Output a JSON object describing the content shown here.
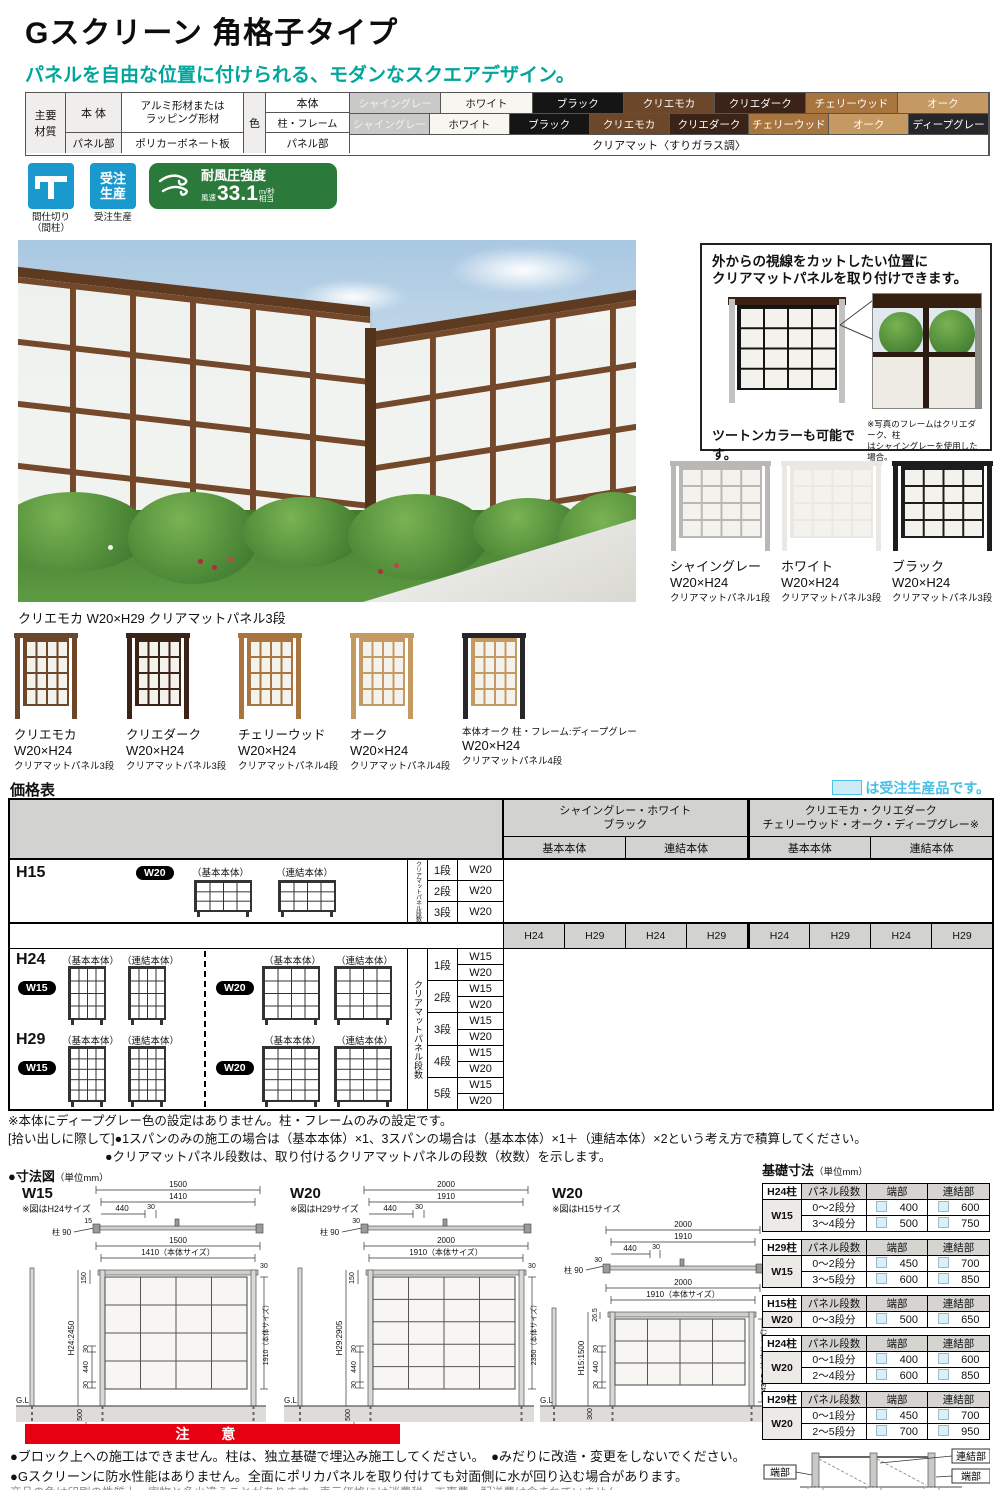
{
  "page": {
    "title": "Gスクリーン 角格子タイプ",
    "subtitle": "パネルを自由な位置に付けられる、モダンなスクエアデザイン。"
  },
  "spec": {
    "material_header_l1": "主要",
    "material_header_l2": "材質",
    "body_label": "本 体",
    "body_value_l1": "アルミ形材または",
    "body_value_l2": "ラッピング形材",
    "panel_label": "パネル部",
    "panel_value": "ポリカーボネート板",
    "color_header": "色",
    "row_body": "本体",
    "row_frame": "柱・フレーム",
    "row_panel": "パネル部",
    "panel_color_value": "クリアマット〈すりガラス調〉",
    "body_colors": [
      {
        "label": "シャイングレー",
        "bg": "#c9c9c7",
        "fg": "#f2f2f0"
      },
      {
        "label": "ホワイト",
        "bg": "#f7f6f1",
        "fg": "#1a1a1a"
      },
      {
        "label": "ブラック",
        "bg": "#151515",
        "fg": "#ffffff"
      },
      {
        "label": "クリエモカ",
        "bg": "#6d4729",
        "fg": "#ffffff"
      },
      {
        "label": "クリエダーク",
        "bg": "#3b2317",
        "fg": "#ffffff"
      },
      {
        "label": "チェリーウッド",
        "bg": "#a9753f",
        "fg": "#ffffff"
      },
      {
        "label": "オーク",
        "bg": "#c59a62",
        "fg": "#ffffff"
      }
    ],
    "frame_colors": [
      {
        "label": "シャイングレー",
        "bg": "#c9c9c7",
        "fg": "#f2f2f0"
      },
      {
        "label": "ホワイト",
        "bg": "#f7f6f1",
        "fg": "#1a1a1a"
      },
      {
        "label": "ブラック",
        "bg": "#151515",
        "fg": "#ffffff"
      },
      {
        "label": "クリエモカ",
        "bg": "#6d4729",
        "fg": "#ffffff"
      },
      {
        "label": "クリエダーク",
        "bg": "#3b2317",
        "fg": "#ffffff"
      },
      {
        "label": "チェリーウッド",
        "bg": "#a9753f",
        "fg": "#ffffff"
      },
      {
        "label": "オーク",
        "bg": "#c59a62",
        "fg": "#ffffff"
      },
      {
        "label": "ディープグレー",
        "bg": "#27272b",
        "fg": "#ffffff"
      }
    ]
  },
  "badges": {
    "partition": {
      "caption_l1": "間仕切り",
      "caption_l2": "（間柱）",
      "icon": "partition-icon"
    },
    "order": {
      "icon_l1": "受注",
      "icon_l2": "生産",
      "caption": "受注生産",
      "icon": "made-to-order-icon"
    },
    "wind": {
      "title": "耐風圧強度",
      "prefix": "風速",
      "value": "33.1",
      "unit_top": "m/秒",
      "unit_bottom": "相当",
      "icon": "wind-icon"
    }
  },
  "photo": {
    "caption": "クリエモカ W20×H29 クリアマットパネル3段"
  },
  "infobox": {
    "heading_l1": "外からの視線をカットしたい位置に",
    "heading_l2": "クリアマットパネルを取り付けできます。",
    "tone": "ツートンカラーも可能です。",
    "note_l1": "※写真のフレームはクリエダーク、柱",
    "note_l2": "はシャイングレーを使用した場合。"
  },
  "variants_right": [
    {
      "name": "シャイングレー",
      "size": "W20×H24",
      "panel": "クリアマットパネル1段",
      "frame": "#b9b8b4",
      "post": "#b9b8b4"
    },
    {
      "name": "ホワイト",
      "size": "W20×H24",
      "panel": "クリアマットパネル3段",
      "frame": "#e9e8e2",
      "post": "#e9e8e2"
    },
    {
      "name": "ブラック",
      "size": "W20×H24",
      "panel": "クリアマットパネル3段",
      "frame": "#1d1d1d",
      "post": "#1d1d1d"
    }
  ],
  "variants_bottom": [
    {
      "name": "クリエモカ",
      "size": "W20×H24",
      "panel": "クリアマットパネル3段",
      "frame": "#6d4729",
      "post": "#6d4729"
    },
    {
      "name": "クリエダーク",
      "size": "W20×H24",
      "panel": "クリアマットパネル3段",
      "frame": "#3b2317",
      "post": "#3b2317"
    },
    {
      "name": "チェリーウッド",
      "size": "W20×H24",
      "panel": "クリアマットパネル4段",
      "frame": "#a9753f",
      "post": "#a9753f"
    },
    {
      "name": "オーク",
      "size": "W20×H24",
      "panel": "クリアマットパネル4段",
      "frame": "#c59a62",
      "post": "#c59a62"
    },
    {
      "name": "本体オーク 柱・フレーム:ディープグレー",
      "size": "W20×H24",
      "panel": "クリアマットパネル4段",
      "frame": "#c59a62",
      "post": "#27272b"
    }
  ],
  "price": {
    "title": "価格表",
    "legend": "は受注生産品です。",
    "group1_l1": "シャイングレー・ホワイト",
    "group1_l2": "ブラック",
    "group2_l1": "クリエモカ・クリエダーク",
    "group2_l2": "チェリーウッド・オーク・ディープグレー※",
    "subcols": [
      "基本本体",
      "連結本体",
      "基本本体",
      "連結本体"
    ],
    "hcols": [
      "H24",
      "H29",
      "H24",
      "H29",
      "H24",
      "H29",
      "H24",
      "H29"
    ],
    "vlabel": "クリアマットパネル段数",
    "basic": "（基本本体）",
    "joint": "（連結本体）",
    "h15": "H15",
    "h24": "H24",
    "h29": "H29",
    "w15": "W15",
    "w20": "W20",
    "h15_rows": [
      {
        "dan": "1段",
        "w": "W20"
      },
      {
        "dan": "2段",
        "w": "W20"
      },
      {
        "dan": "3段",
        "w": "W20"
      }
    ],
    "dan_rows": [
      {
        "dan": "1段",
        "w1": "W15",
        "w2": "W20"
      },
      {
        "dan": "2段",
        "w1": "W15",
        "w2": "W20"
      },
      {
        "dan": "3段",
        "w1": "W15",
        "w2": "W20"
      },
      {
        "dan": "4段",
        "w1": "W15",
        "w2": "W20"
      },
      {
        "dan": "5段",
        "w1": "W15",
        "w2": "W20"
      }
    ]
  },
  "notes": [
    "※本体にディープグレー色の設定はありません。柱・フレームのみの設定です。",
    "[拾い出しに際して]●1スパンのみの施工の場合は（基本本体）×1、3スパンの場合は（基本本体）×1＋（連結本体）×2という考え方で積算してください。",
    "●クリアマットパネル段数は、取り付けるクリアマットパネルの段数（枚数）を示します。"
  ],
  "dims": {
    "heading": "●寸法図",
    "unit": "（単位mm）",
    "w15": {
      "title": "W15",
      "note": "※図はH24サイズ",
      "p1": "1500",
      "p2": "1410",
      "p3": "440",
      "p4": "30",
      "p5": "15",
      "post": "柱 90",
      "f1": "1500",
      "f2": "1410（本体サイズ）",
      "l1": "150",
      "l2": "H24:2450",
      "l3": "30",
      "l4": "440",
      "l5": "30",
      "l6": "500",
      "r1": "30",
      "r2": "1910（本体サイズ）",
      "gl": "G.L"
    },
    "w20a": {
      "title": "W20",
      "note": "※図はH29サイズ",
      "p1": "2000",
      "p2": "1910",
      "p3": "440",
      "p4": "30",
      "p5": "30",
      "post": "柱 90",
      "f1": "2000",
      "f2": "1910（本体サイズ）",
      "l1": "150",
      "l2": "H29:2905",
      "l3": "30",
      "l4": "440",
      "l5": "30",
      "l6": "500",
      "r1": "30",
      "r2": "2350（本体サイズ）",
      "gl": "G.L"
    },
    "w20b": {
      "title": "W20",
      "note": "※図はH15サイズ",
      "p1": "2000",
      "p2": "1910",
      "p3": "440",
      "p4": "30",
      "p5": "30",
      "post": "柱 90",
      "f1": "2000",
      "f2": "1910（本体サイズ）",
      "l1": "26.5",
      "l2": "H15:1500",
      "l3": "30",
      "l4": "440",
      "l5": "30",
      "l6": "300",
      "r2": "1436.5（本体サイズ）",
      "gl": "G.L"
    }
  },
  "foundation": {
    "heading": "基礎寸法",
    "unit": "（単位mm）",
    "cols": [
      "パネル段数",
      "端部",
      "連結部"
    ],
    "tables": [
      {
        "post": "H24柱",
        "width": "W15",
        "rows": [
          {
            "range": "0〜2段分",
            "edge": "400",
            "joint": "600"
          },
          {
            "range": "3〜4段分",
            "edge": "500",
            "joint": "750"
          }
        ]
      },
      {
        "post": "H29柱",
        "width": "W15",
        "rows": [
          {
            "range": "0〜2段分",
            "edge": "450",
            "joint": "700"
          },
          {
            "range": "3〜5段分",
            "edge": "600",
            "joint": "850"
          }
        ]
      },
      {
        "post": "H15柱",
        "width": "W20",
        "rows": [
          {
            "range": "0〜3段分",
            "edge": "500",
            "joint": "650"
          }
        ]
      },
      {
        "post": "H24柱",
        "width": "W20",
        "rows": [
          {
            "range": "0〜1段分",
            "edge": "400",
            "joint": "600"
          },
          {
            "range": "2〜4段分",
            "edge": "600",
            "joint": "850"
          }
        ]
      },
      {
        "post": "H29柱",
        "width": "W20",
        "rows": [
          {
            "range": "0〜1段分",
            "edge": "450",
            "joint": "700"
          },
          {
            "range": "2〜5段分",
            "edge": "700",
            "joint": "950"
          }
        ]
      }
    ],
    "diagram": [
      "端部",
      "連結部",
      "端部"
    ]
  },
  "caution": {
    "banner": "注 意",
    "lines": [
      "●ブロック上への施工はできません。柱は、独立基礎で埋込み施工してください。　●みだりに改造・変更をしないでください。",
      "●Gスクリーンに防水性能はありません。全面にポリカパネルを取り付けても対面側に水が回り込む場合があります。"
    ],
    "footer": "商品の色は印刷の性質上、実物と多少違うことがあります。表示価格には消費税、工事費、配送費は含まれていません。"
  },
  "colors": {
    "accent_teal": "#00a59b",
    "legend_blue": "#45bfe3",
    "legend_fill": "#cdeaf6",
    "badge_blue": "#1a99cf",
    "wind_green": "#2b7a3b",
    "caution_red": "#e60012",
    "table_gray": "#d2d2d0"
  }
}
